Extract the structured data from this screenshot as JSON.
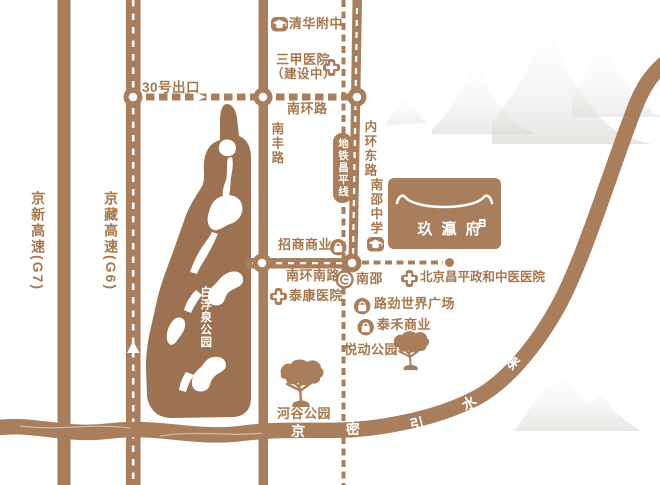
{
  "colors": {
    "accent_brown": "#a87e5c",
    "park_fill": "#9d7252",
    "label_brown": "#a5784f",
    "map_white": "#ffffff",
    "mountain_gray": "#d7d4d0"
  },
  "highways": {
    "g7_label": "京新高速(G7)",
    "g6_label": "京藏高速(G6)",
    "exit_label": "30号出口"
  },
  "roads": {
    "nanhuanlu": "南环路",
    "nanfenglu": "南丰路",
    "neihuandonglu": "内环东路",
    "nanhuannanlu": "南环南路"
  },
  "metro": {
    "line_label": "地铁昌平线",
    "station_label": "南邵"
  },
  "canal": {
    "name": "京密引水渠",
    "chars": [
      "京",
      "密",
      "引",
      "水",
      "渠"
    ]
  },
  "schools": [
    {
      "label": "清华附中"
    },
    {
      "label": "南邵中学"
    }
  ],
  "hospitals": [
    {
      "label": "三甲医院",
      "note": "（建设中）"
    },
    {
      "label": "泰康医院"
    },
    {
      "label": "北京昌平政和中医医院"
    }
  ],
  "malls": [
    {
      "label": "招商商业"
    },
    {
      "label": "路劲世界广场"
    },
    {
      "label": "泰禾商业"
    }
  ],
  "parks": [
    {
      "label": "白浮泉公园"
    },
    {
      "label": "悦动公园"
    },
    {
      "label": "河谷公园"
    }
  ],
  "project": {
    "name": "玖瀛府"
  }
}
